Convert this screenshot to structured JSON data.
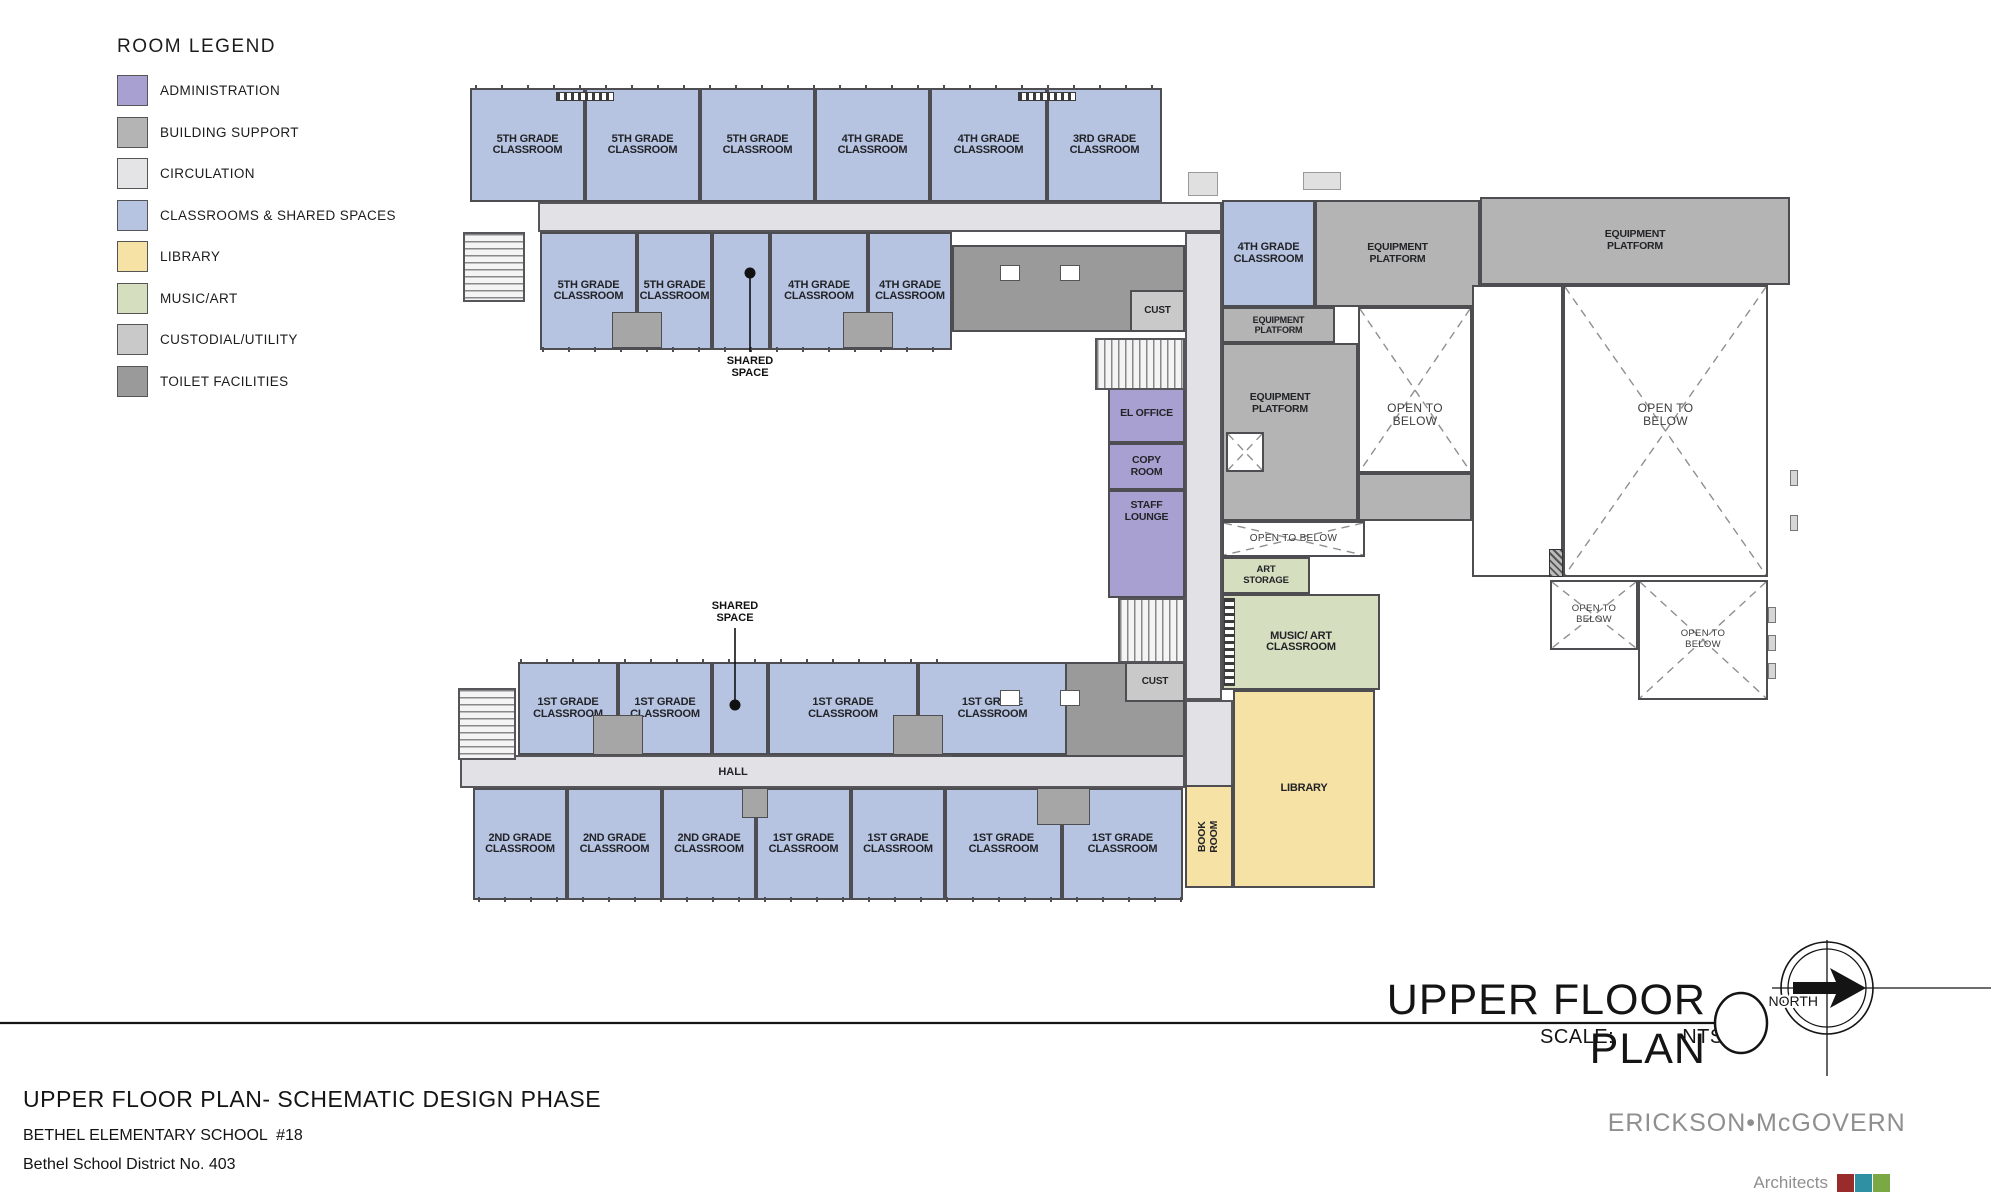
{
  "legend": {
    "title": "ROOM LEGEND",
    "items": [
      {
        "label": "ADMINISTRATION",
        "color": "#a9a0d2"
      },
      {
        "label": "BUILDING SUPPORT",
        "color": "#b4b4b4"
      },
      {
        "label": "CIRCULATION",
        "color": "#e4e4e6"
      },
      {
        "label": "CLASSROOMS & SHARED SPACES",
        "color": "#b6c3e1"
      },
      {
        "label": "LIBRARY",
        "color": "#f5e2a4"
      },
      {
        "label": "MUSIC/ART",
        "color": "#d5dfc0"
      },
      {
        "label": "CUSTODIAL/UTILITY",
        "color": "#c9c9c9"
      },
      {
        "label": "TOILET FACILITIES",
        "color": "#9a9a9a"
      }
    ]
  },
  "plan": {
    "rooms": [
      {
        "name": "classroom-5th-1",
        "label": "5TH GRADE\nCLASSROOM",
        "cat": "classroom",
        "x": 470,
        "y": 88,
        "w": 115,
        "h": 114
      },
      {
        "name": "classroom-5th-2",
        "label": "5TH GRADE\nCLASSROOM",
        "cat": "classroom",
        "x": 585,
        "y": 88,
        "w": 115,
        "h": 114
      },
      {
        "name": "classroom-5th-3",
        "label": "5TH GRADE\nCLASSROOM",
        "cat": "classroom",
        "x": 700,
        "y": 88,
        "w": 115,
        "h": 114
      },
      {
        "name": "classroom-4th-1",
        "label": "4TH GRADE\nCLASSROOM",
        "cat": "classroom",
        "x": 815,
        "y": 88,
        "w": 115,
        "h": 114
      },
      {
        "name": "classroom-4th-2",
        "label": "4TH GRADE\nCLASSROOM",
        "cat": "classroom",
        "x": 930,
        "y": 88,
        "w": 117,
        "h": 114
      },
      {
        "name": "classroom-3rd-1",
        "label": "3RD GRADE\nCLASSROOM",
        "cat": "classroom",
        "x": 1047,
        "y": 88,
        "w": 115,
        "h": 114
      },
      {
        "name": "classroom-5th-4",
        "label": "5TH GRADE\nCLASSROOM",
        "cat": "classroom",
        "x": 540,
        "y": 232,
        "w": 97,
        "h": 118
      },
      {
        "name": "classroom-5th-5",
        "label": "5TH GRADE\nCLASSROOM",
        "cat": "classroom",
        "x": 637,
        "y": 232,
        "w": 75,
        "h": 118
      },
      {
        "name": "shared-space-top",
        "label": "",
        "cat": "classroom",
        "x": 712,
        "y": 232,
        "w": 58,
        "h": 118
      },
      {
        "name": "classroom-4th-3",
        "label": "4TH GRADE\nCLASSROOM",
        "cat": "classroom",
        "x": 770,
        "y": 232,
        "w": 98,
        "h": 118
      },
      {
        "name": "classroom-4th-4",
        "label": "4TH GRADE\nCLASSROOM",
        "cat": "classroom",
        "x": 868,
        "y": 232,
        "w": 84,
        "h": 118
      },
      {
        "name": "toilet-block-top",
        "label": "",
        "cat": "toilet",
        "x": 952,
        "y": 245,
        "w": 233,
        "h": 87
      },
      {
        "name": "cust-top",
        "label": "CUST",
        "cat": "cust",
        "x": 1130,
        "y": 290,
        "w": 55,
        "h": 42,
        "fs": 10
      },
      {
        "name": "classroom-4th-5",
        "label": "4TH GRADE\nCLASSROOM",
        "cat": "classroom",
        "x": 1222,
        "y": 200,
        "w": 93,
        "h": 107
      },
      {
        "name": "equipment-platform-top-center",
        "label": "EQUIPMENT\nPLATFORM",
        "cat": "support",
        "x": 1315,
        "y": 200,
        "w": 165,
        "h": 107,
        "fs": 10.5
      },
      {
        "name": "equipment-platform-top-right",
        "label": "EQUIPMENT\nPLATFORM",
        "cat": "support",
        "x": 1480,
        "y": 197,
        "w": 310,
        "h": 88,
        "fs": 10.5
      },
      {
        "name": "equipment-platform-strip",
        "label": "EQUIPMENT\nPLATFORM",
        "cat": "support",
        "x": 1222,
        "y": 307,
        "w": 113,
        "h": 36,
        "fs": 9
      },
      {
        "name": "equipment-platform-big",
        "label": "EQUIPMENT\nPLATFORM",
        "cat": "support",
        "x": 1222,
        "y": 343,
        "w": 136,
        "h": 178,
        "fs": 10.5,
        "ldx": -10,
        "ldy": -28
      },
      {
        "name": "equipment-platform-under",
        "label": "",
        "cat": "support",
        "x": 1358,
        "y": 473,
        "w": 114,
        "h": 48
      },
      {
        "name": "el-office",
        "label": "EL OFFICE",
        "cat": "admin",
        "x": 1108,
        "y": 385,
        "w": 77,
        "h": 58,
        "fs": 10.5
      },
      {
        "name": "copy-room",
        "label": "COPY\nROOM",
        "cat": "admin",
        "x": 1108,
        "y": 443,
        "w": 77,
        "h": 47,
        "fs": 10.5
      },
      {
        "name": "staff-lounge",
        "label": "STAFF\nLOUNGE",
        "cat": "admin",
        "x": 1108,
        "y": 490,
        "w": 77,
        "h": 108,
        "fs": 10.5,
        "ldy": -32
      },
      {
        "name": "art-storage",
        "label": "ART\nSTORAGE",
        "cat": "music",
        "x": 1222,
        "y": 557,
        "w": 88,
        "h": 37,
        "fs": 9.5
      },
      {
        "name": "music-art-classroom",
        "label": "MUSIC/ ART\nCLASSROOM",
        "cat": "music",
        "x": 1222,
        "y": 594,
        "w": 158,
        "h": 96
      },
      {
        "name": "library",
        "label": "LIBRARY",
        "cat": "library",
        "x": 1233,
        "y": 690,
        "w": 142,
        "h": 198
      },
      {
        "name": "book-room",
        "label": "BOOK\nROOM",
        "cat": "library",
        "x": 1185,
        "y": 785,
        "w": 48,
        "h": 103,
        "rot": true,
        "fs": 10.5
      },
      {
        "name": "toilet-block-bottom",
        "label": "",
        "cat": "toilet",
        "x": 952,
        "y": 662,
        "w": 233,
        "h": 95
      },
      {
        "name": "cust-bottom",
        "label": "CUST",
        "cat": "cust",
        "x": 1125,
        "y": 662,
        "w": 60,
        "h": 40,
        "fs": 10
      },
      {
        "name": "classroom-1st-1",
        "label": "1ST GRADE\nCLASSROOM",
        "cat": "classroom",
        "x": 518,
        "y": 662,
        "w": 100,
        "h": 93
      },
      {
        "name": "classroom-1st-2",
        "label": "1ST GRADE\nCLASSROOM",
        "cat": "classroom",
        "x": 618,
        "y": 662,
        "w": 94,
        "h": 93
      },
      {
        "name": "shared-space-bottom",
        "label": "",
        "cat": "classroom",
        "x": 712,
        "y": 662,
        "w": 56,
        "h": 93
      },
      {
        "name": "classroom-1st-3",
        "label": "1ST GRADE\nCLASSROOM",
        "cat": "classroom",
        "x": 768,
        "y": 662,
        "w": 150,
        "h": 93
      },
      {
        "name": "classroom-1st-4",
        "label": "1ST GRADE\nCLASSROOM",
        "cat": "classroom",
        "x": 918,
        "y": 662,
        "w": 149,
        "h": 93
      },
      {
        "name": "classroom-2nd-1",
        "label": "2ND GRADE\nCLASSROOM",
        "cat": "classroom",
        "x": 473,
        "y": 788,
        "w": 94,
        "h": 112
      },
      {
        "name": "classroom-2nd-2",
        "label": "2ND GRADE\nCLASSROOM",
        "cat": "classroom",
        "x": 567,
        "y": 788,
        "w": 95,
        "h": 112
      },
      {
        "name": "classroom-2nd-3",
        "label": "2ND GRADE\nCLASSROOM",
        "cat": "classroom",
        "x": 662,
        "y": 788,
        "w": 94,
        "h": 112
      },
      {
        "name": "classroom-1st-5",
        "label": "1ST GRADE\nCLASSROOM",
        "cat": "classroom",
        "x": 756,
        "y": 788,
        "w": 95,
        "h": 112
      },
      {
        "name": "classroom-1st-6",
        "label": "1ST GRADE\nCLASSROOM",
        "cat": "classroom",
        "x": 851,
        "y": 788,
        "w": 94,
        "h": 112
      },
      {
        "name": "classroom-1st-7",
        "label": "1ST GRADE\nCLASSROOM",
        "cat": "classroom",
        "x": 945,
        "y": 788,
        "w": 117,
        "h": 112
      },
      {
        "name": "classroom-1st-8",
        "label": "1ST GRADE\nCLASSROOM",
        "cat": "classroom",
        "x": 1062,
        "y": 788,
        "w": 121,
        "h": 112
      }
    ],
    "open_areas": [
      {
        "name": "open-to-below-center",
        "label": "OPEN TO\nBELOW",
        "x": 1358,
        "y": 307,
        "w": 114,
        "h": 166,
        "fs": 12,
        "ldy": 25,
        "xlines": true
      },
      {
        "name": "open-to-below-strip",
        "label": "OPEN TO  BELOW",
        "x": 1222,
        "y": 521,
        "w": 143,
        "h": 36,
        "fs": 10,
        "xlines": true
      },
      {
        "name": "void-alley",
        "label": "",
        "x": 1472,
        "y": 285,
        "w": 91,
        "h": 292,
        "xlines": false
      },
      {
        "name": "open-to-below-right",
        "label": "OPEN TO\nBELOW",
        "x": 1563,
        "y": 285,
        "w": 205,
        "h": 292,
        "fs": 12,
        "ldy": -16,
        "xlines": true
      },
      {
        "name": "open-to-below-low-left",
        "label": "OPEN TO\nBELOW",
        "x": 1550,
        "y": 580,
        "w": 88,
        "h": 70,
        "fs": 9.5,
        "xlines": true
      },
      {
        "name": "open-to-below-low-right",
        "label": "OPEN TO\nBELOW",
        "x": 1638,
        "y": 580,
        "w": 130,
        "h": 120,
        "fs": 9.5,
        "xlines": true
      }
    ],
    "corridors": [
      {
        "name": "corridor-top-wing",
        "x": 538,
        "y": 202,
        "w": 684,
        "h": 30
      },
      {
        "name": "corridor-spine",
        "x": 1185,
        "y": 232,
        "w": 37,
        "h": 468
      },
      {
        "name": "corridor-junction",
        "x": 1185,
        "y": 700,
        "w": 48,
        "h": 88
      },
      {
        "name": "corridor-hall",
        "x": 460,
        "y": 755,
        "w": 725,
        "h": 33
      }
    ],
    "stairs": [
      {
        "name": "stair-top-wing-left",
        "x": 463,
        "y": 232,
        "w": 62,
        "h": 70,
        "dir": "v"
      },
      {
        "name": "stair-spine-upper",
        "x": 1095,
        "y": 338,
        "w": 90,
        "h": 52,
        "dir": "h"
      },
      {
        "name": "stair-spine-lower",
        "x": 1118,
        "y": 598,
        "w": 67,
        "h": 65,
        "dir": "h"
      },
      {
        "name": "stair-bottom-wing-left",
        "x": 458,
        "y": 688,
        "w": 58,
        "h": 72,
        "dir": "v"
      }
    ],
    "fixtures": [
      {
        "name": "pod-5th-pair",
        "kind": "pod",
        "x": 612,
        "y": 312,
        "w": 50,
        "h": 36
      },
      {
        "name": "pod-4th-pair",
        "kind": "pod",
        "x": 843,
        "y": 312,
        "w": 50,
        "h": 36
      },
      {
        "name": "pod-1st-pair-a",
        "kind": "pod",
        "x": 593,
        "y": 715,
        "w": 50,
        "h": 40
      },
      {
        "name": "pod-1st-pair-b",
        "kind": "pod",
        "x": 893,
        "y": 715,
        "w": 50,
        "h": 40
      },
      {
        "name": "pod-lower-a",
        "kind": "pod",
        "x": 742,
        "y": 788,
        "w": 26,
        "h": 30
      },
      {
        "name": "pod-lower-b",
        "kind": "pod",
        "x": 1037,
        "y": 788,
        "w": 53,
        "h": 37
      },
      {
        "name": "locker-top-bar-a",
        "kind": "locker",
        "x": 556,
        "y": 92,
        "w": 58,
        "h": 9
      },
      {
        "name": "locker-top-bar-b",
        "kind": "locker",
        "x": 1018,
        "y": 92,
        "w": 58,
        "h": 9
      },
      {
        "name": "locker-music-wall",
        "kind": "locker-v",
        "x": 1224,
        "y": 598,
        "w": 11,
        "h": 88
      },
      {
        "name": "elevator",
        "kind": "elev",
        "x": 1226,
        "y": 432,
        "w": 38,
        "h": 40,
        "xlines": true
      },
      {
        "name": "shaft",
        "kind": "shaft",
        "x": 1549,
        "y": 549,
        "w": 14,
        "h": 28
      },
      {
        "name": "ext-box-a",
        "kind": "extbox",
        "x": 1188,
        "y": 172,
        "w": 30,
        "h": 24
      },
      {
        "name": "ext-box-b",
        "kind": "extbox",
        "x": 1303,
        "y": 172,
        "w": 38,
        "h": 18
      },
      {
        "name": "wall-tab-a",
        "kind": "tab",
        "x": 1768,
        "y": 607,
        "w": 8,
        "h": 16
      },
      {
        "name": "wall-tab-b",
        "kind": "tab",
        "x": 1768,
        "y": 635,
        "w": 8,
        "h": 16
      },
      {
        "name": "wall-tab-c",
        "kind": "tab",
        "x": 1768,
        "y": 663,
        "w": 8,
        "h": 16
      },
      {
        "name": "wall-tab-d",
        "kind": "tab",
        "x": 1790,
        "y": 470,
        "w": 8,
        "h": 16
      },
      {
        "name": "wall-tab-e",
        "kind": "tab",
        "x": 1790,
        "y": 515,
        "w": 8,
        "h": 16
      },
      {
        "name": "fixture-top-a",
        "kind": "fix",
        "x": 1000,
        "y": 265,
        "w": 20,
        "h": 16
      },
      {
        "name": "fixture-top-b",
        "kind": "fix",
        "x": 1060,
        "y": 265,
        "w": 20,
        "h": 16
      },
      {
        "name": "fixture-bottom-a",
        "kind": "fix",
        "x": 1000,
        "y": 690,
        "w": 20,
        "h": 16
      },
      {
        "name": "fixture-bottom-b",
        "kind": "fix",
        "x": 1060,
        "y": 690,
        "w": 20,
        "h": 16
      },
      {
        "name": "window-strip-top-bar",
        "kind": "win",
        "x": 475,
        "y": 85,
        "w": 687,
        "h": 5
      },
      {
        "name": "window-strip-second-bar",
        "kind": "win",
        "x": 542,
        "y": 347,
        "w": 410,
        "h": 5
      },
      {
        "name": "window-strip-upper-bar",
        "kind": "win",
        "x": 520,
        "y": 659,
        "w": 430,
        "h": 5
      },
      {
        "name": "window-strip-lower-bar",
        "kind": "win",
        "x": 478,
        "y": 897,
        "w": 704,
        "h": 5
      }
    ],
    "leaders": [
      {
        "name": "shared-space-leader-top",
        "text": "SHARED\nSPACE",
        "tx": 750,
        "ty": 355,
        "x": 750,
        "y1": 273,
        "y2": 352,
        "dot_y": 273
      },
      {
        "name": "shared-space-leader-bottom",
        "text": "SHARED\nSPACE",
        "tx": 735,
        "ty": 600,
        "x": 735,
        "y1": 628,
        "y2": 705,
        "dot_y": 705
      }
    ],
    "misc_labels": [
      {
        "name": "hall-label",
        "text": "HALL",
        "x": 733,
        "y": 772
      }
    ]
  },
  "titleblock": {
    "title": "UPPER FLOOR PLAN",
    "scale_label": "SCALE:",
    "scale_value": "NTS",
    "north_label": "NORTH"
  },
  "footer": {
    "line1": "UPPER FLOOR PLAN- SCHEMATIC DESIGN PHASE",
    "line2": "BETHEL ELEMENTARY SCHOOL  #18",
    "line3": "Bethel School District No. 403"
  },
  "firm": {
    "name_left": "ERICKSON",
    "separator": "•",
    "name_right": "McGOVERN",
    "tagline": "Architects",
    "squares": [
      "#9a2b2b",
      "#2f8fa3",
      "#79a844"
    ]
  }
}
